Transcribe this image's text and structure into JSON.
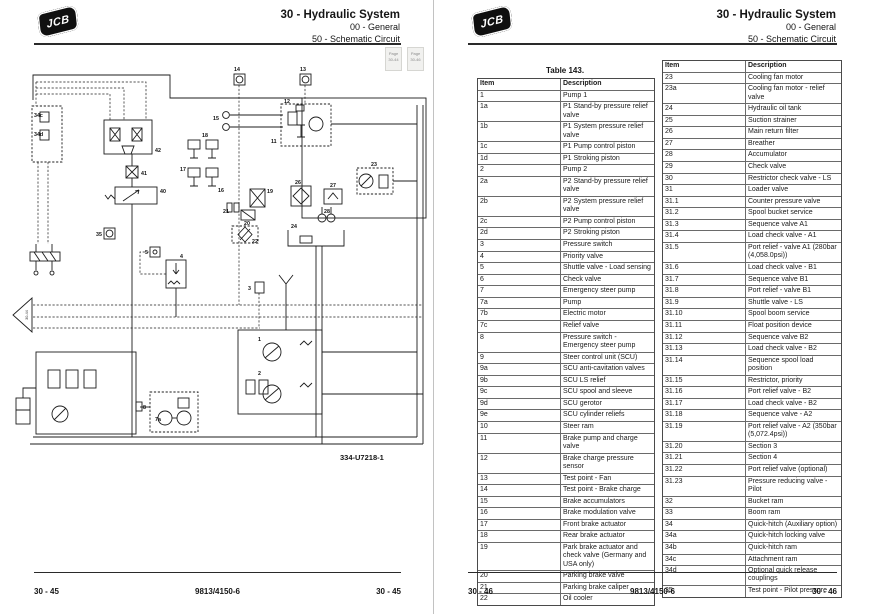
{
  "header": {
    "title": "30 - Hydraulic System",
    "line2": "00 - General",
    "line3": "50 - Schematic Circuit"
  },
  "logo_text": "JCB",
  "left_page": {
    "page_nav": [
      {
        "top": "Page",
        "bottom": "30-44"
      },
      {
        "top": "Page",
        "bottom": "30-46"
      }
    ],
    "continuation_label": "30-44",
    "figure_ref": "334-U7218-1",
    "footer": {
      "left": "30 - 45",
      "center": "9813/4150-6",
      "right": "30 - 45"
    },
    "diagram_labels": [
      {
        "t": "14",
        "x": 234,
        "y": 71
      },
      {
        "t": "13",
        "x": 300,
        "y": 71
      },
      {
        "t": "12",
        "x": 284,
        "y": 103
      },
      {
        "t": "11",
        "x": 271,
        "y": 143
      },
      {
        "t": "15",
        "x": 213,
        "y": 120
      },
      {
        "t": "18",
        "x": 202,
        "y": 137
      },
      {
        "t": "17",
        "x": 180,
        "y": 171
      },
      {
        "t": "16",
        "x": 218,
        "y": 192
      },
      {
        "t": "23",
        "x": 371,
        "y": 166
      },
      {
        "t": "19",
        "x": 267,
        "y": 193
      },
      {
        "t": "20",
        "x": 244,
        "y": 225
      },
      {
        "t": "21",
        "x": 223,
        "y": 213
      },
      {
        "t": "26",
        "x": 295,
        "y": 184
      },
      {
        "t": "27",
        "x": 330,
        "y": 187
      },
      {
        "t": "28",
        "x": 324,
        "y": 213
      },
      {
        "t": "24",
        "x": 291,
        "y": 228
      },
      {
        "t": "22",
        "x": 252,
        "y": 243
      },
      {
        "t": "42",
        "x": 155,
        "y": 152
      },
      {
        "t": "41",
        "x": 141,
        "y": 175
      },
      {
        "t": "40",
        "x": 160,
        "y": 193
      },
      {
        "t": "34c",
        "x": 34,
        "y": 117
      },
      {
        "t": "34d",
        "x": 34,
        "y": 136
      },
      {
        "t": "35",
        "x": 96,
        "y": 236
      },
      {
        "t": "5",
        "x": 145,
        "y": 254
      },
      {
        "t": "4",
        "x": 180,
        "y": 258
      },
      {
        "t": "3",
        "x": 248,
        "y": 290
      },
      {
        "t": "1",
        "x": 258,
        "y": 341
      },
      {
        "t": "2",
        "x": 258,
        "y": 375
      },
      {
        "t": "7a",
        "x": 155,
        "y": 421
      },
      {
        "t": "8",
        "x": 143,
        "y": 409
      }
    ]
  },
  "right_page": {
    "table_title": "Table 143.",
    "col_headers": [
      "Item",
      "Description"
    ],
    "table_left": [
      [
        "1",
        "Pump 1"
      ],
      [
        "1a",
        "P1 Stand-by pressure relief valve"
      ],
      [
        "1b",
        "P1 System pressure relief valve"
      ],
      [
        "1c",
        "P1 Pump control piston"
      ],
      [
        "1d",
        "P1 Stroking piston"
      ],
      [
        "2",
        "Pump 2"
      ],
      [
        "2a",
        "P2 Stand-by pressure relief valve"
      ],
      [
        "2b",
        "P2 System pressure relief valve"
      ],
      [
        "2c",
        "P2 Pump control piston"
      ],
      [
        "2d",
        "P2 Stroking piston"
      ],
      [
        "3",
        "Pressure switch"
      ],
      [
        "4",
        "Priority valve"
      ],
      [
        "5",
        "Shuttle valve - Load sensing"
      ],
      [
        "6",
        "Check valve"
      ],
      [
        "7",
        "Emergency steer pump"
      ],
      [
        "7a",
        "Pump"
      ],
      [
        "7b",
        "Electric motor"
      ],
      [
        "7c",
        "Relief valve"
      ],
      [
        "8",
        "Pressure switch - Emergency steer pump"
      ],
      [
        "9",
        "Steer control unit (SCU)"
      ],
      [
        "9a",
        "SCU anti-cavitation valves"
      ],
      [
        "9b",
        "SCU LS relief"
      ],
      [
        "9c",
        "SCU spool and sleeve"
      ],
      [
        "9d",
        "SCU gerotor"
      ],
      [
        "9e",
        "SCU cylinder reliefs"
      ],
      [
        "10",
        "Steer ram"
      ],
      [
        "11",
        "Brake pump and charge valve"
      ],
      [
        "12",
        "Brake charge pressure sensor"
      ],
      [
        "13",
        "Test point - Fan"
      ],
      [
        "14",
        "Test point - Brake charge"
      ],
      [
        "15",
        "Brake accumulators"
      ],
      [
        "16",
        "Brake modulation valve"
      ],
      [
        "17",
        "Front brake actuator"
      ],
      [
        "18",
        "Rear brake actuator"
      ],
      [
        "19",
        "Park brake actuator and check valve (Germany and USA only)"
      ],
      [
        "20",
        "Parking brake valve"
      ],
      [
        "21",
        "Parking brake caliper"
      ],
      [
        "22",
        "Oil cooler"
      ]
    ],
    "table_right": [
      [
        "23",
        "Cooling fan motor"
      ],
      [
        "23a",
        "Cooling fan motor - relief valve"
      ],
      [
        "24",
        "Hydraulic oil tank"
      ],
      [
        "25",
        "Suction strainer"
      ],
      [
        "26",
        "Main return filter"
      ],
      [
        "27",
        "Breather"
      ],
      [
        "28",
        "Accumulator"
      ],
      [
        "29",
        "Check valve"
      ],
      [
        "30",
        "Restrictor check valve - LS"
      ],
      [
        "31",
        "Loader valve"
      ],
      [
        "31.1",
        "Counter pressure valve"
      ],
      [
        "31.2",
        "Spool bucket service"
      ],
      [
        "31.3",
        "Sequence valve A1"
      ],
      [
        "31.4",
        "Load check valve - A1"
      ],
      [
        "31.5",
        "Port relief - valve A1 (280bar (4,058.0psi))"
      ],
      [
        "31.6",
        "Load check valve - B1"
      ],
      [
        "31.7",
        "Sequence valve B1"
      ],
      [
        "31.8",
        "Port relief - valve B1"
      ],
      [
        "31.9",
        "Shuttle valve - LS"
      ],
      [
        "31.10",
        "Spool boom service"
      ],
      [
        "31.11",
        "Float position device"
      ],
      [
        "31.12",
        "Sequence valve B2"
      ],
      [
        "31.13",
        "Load check valve - B2"
      ],
      [
        "31.14",
        "Sequence spool load position"
      ],
      [
        "31.15",
        "Restrictor, priority"
      ],
      [
        "31.16",
        "Port relief valve - B2"
      ],
      [
        "31.17",
        "Load check valve - B2"
      ],
      [
        "31.18",
        "Sequence valve - A2"
      ],
      [
        "31.19",
        "Port relief valve - A2 (350bar (5,072.4psi))"
      ],
      [
        "31.20",
        "Section 3"
      ],
      [
        "31.21",
        "Section 4"
      ],
      [
        "31.22",
        "Port relief valve (optional)"
      ],
      [
        "31.23",
        "Pressure reducing valve - Pilot"
      ],
      [
        "32",
        "Bucket ram"
      ],
      [
        "33",
        "Boom ram"
      ],
      [
        "34",
        "Quick-hitch (Auxiliary option)"
      ],
      [
        "34a",
        "Quick-hitch locking valve"
      ],
      [
        "34b",
        "Quick-hitch ram"
      ],
      [
        "34c",
        "Attachment ram"
      ],
      [
        "34d",
        "Optional quick release couplings"
      ],
      [
        "35",
        "Test point - Pilot pressure"
      ]
    ],
    "footer": {
      "left": "30 - 46",
      "center": "9813/4150-6",
      "right": "30 - 46"
    }
  },
  "colors": {
    "line": "#1c1c1c",
    "page": "#ffffff",
    "backdrop": "#d9d9d9"
  }
}
